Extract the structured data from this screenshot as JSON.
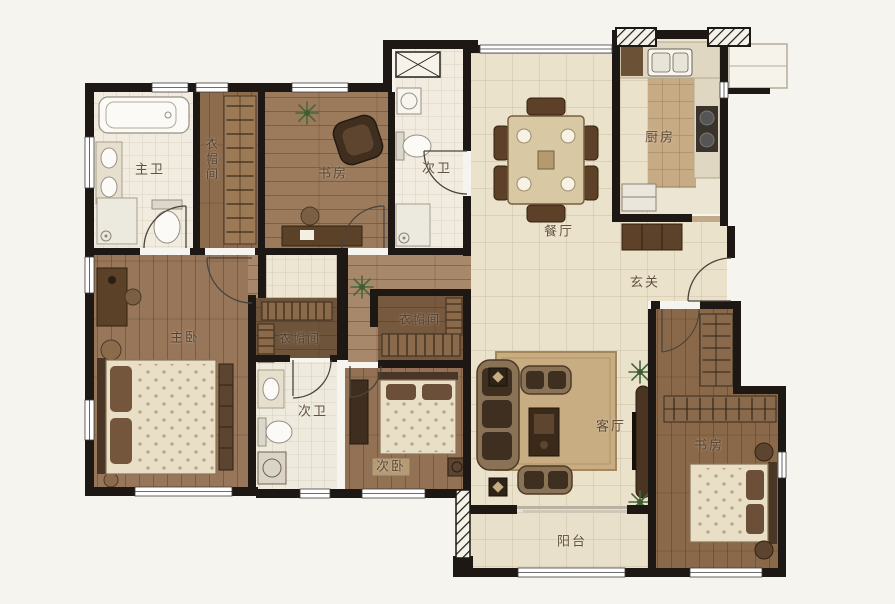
{
  "plan": {
    "rooms": {
      "master_bath": {
        "label": "主卫"
      },
      "closet_top": {
        "label": "衣帽间"
      },
      "study_top": {
        "label": "书房"
      },
      "bath_top": {
        "label": "次卫"
      },
      "kitchen": {
        "label": "厨房"
      },
      "dining": {
        "label": "餐厅"
      },
      "entry": {
        "label": "玄关"
      },
      "master_bedroom": {
        "label": "主卧"
      },
      "closet_master": {
        "label": "衣帽间"
      },
      "closet_middle": {
        "label": "衣帽间"
      },
      "bath_bottom": {
        "label": "次卫"
      },
      "bedroom_second": {
        "label": "次卧"
      },
      "living": {
        "label": "客厅"
      },
      "balcony": {
        "label": "阳台"
      },
      "study_bottom": {
        "label": "书房"
      }
    },
    "colors": {
      "wall": "#1d1813",
      "wood_floor": "#97765a",
      "wood_floor_dark": "#7c5e44",
      "tile_floor": "#ebe2cb",
      "bath_tile": "#f1ecdf",
      "kitchen_tile": "#c7ab85",
      "label_text": "#4e3d2c"
    }
  }
}
